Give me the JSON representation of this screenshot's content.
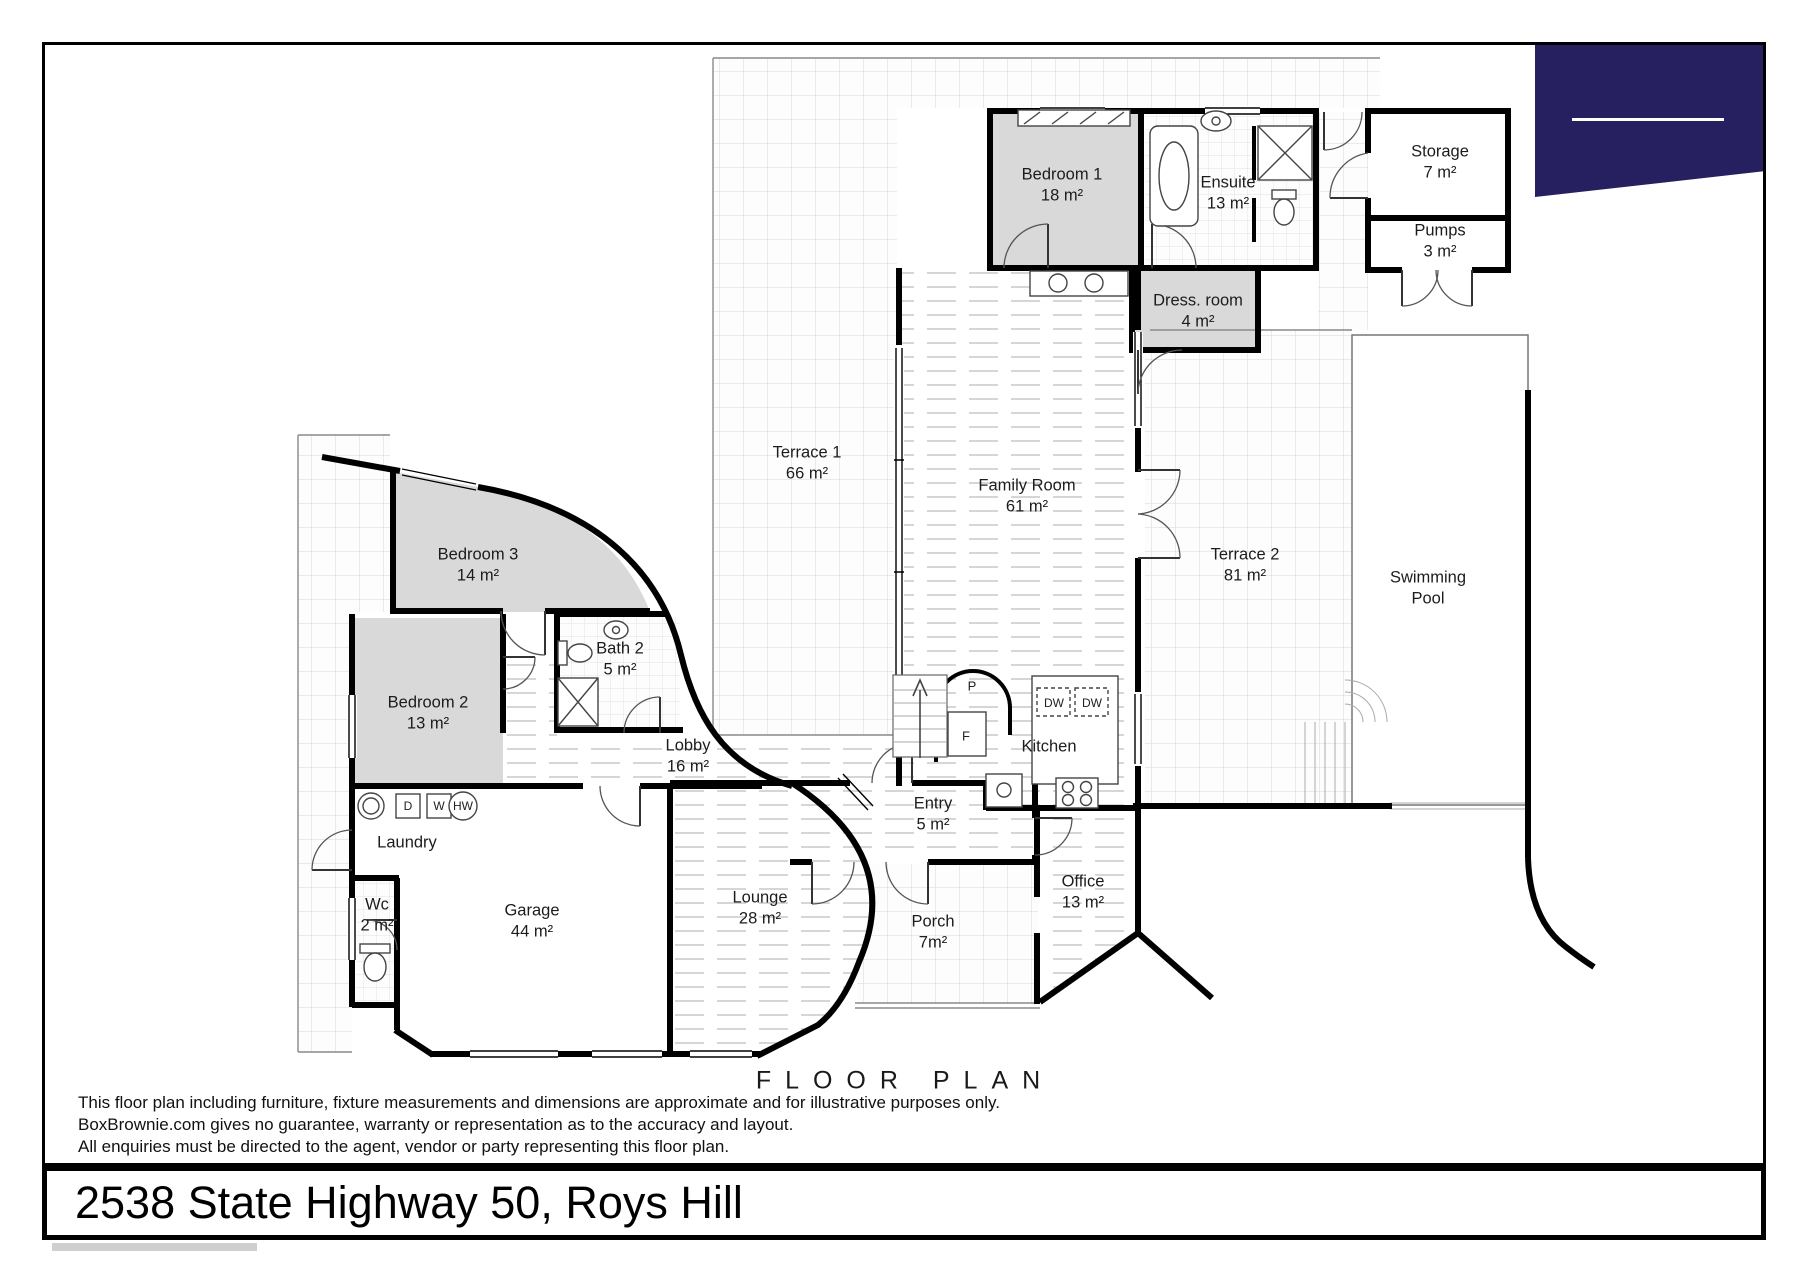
{
  "title": "FLOOR PLAN",
  "address": "2538 State Highway 50, Roys Hill",
  "disclaimer": {
    "line1": "This floor plan including furniture, fixture measurements and dimensions are approximate and for illustrative purposes only.",
    "line2": "BoxBrownie.com gives no guarantee, warranty or representation as to the accuracy and layout.",
    "line3": "All enquiries must be directed to the agent, vendor or party representing this floor plan."
  },
  "rooms": [
    {
      "id": "bedroom-1",
      "line1": "Bedroom 1",
      "line2": "18 m²"
    },
    {
      "id": "ensuite",
      "line1": "Ensuite",
      "line2": "13 m²"
    },
    {
      "id": "storage",
      "line1": "Storage",
      "line2": "7 m²"
    },
    {
      "id": "pumps",
      "line1": "Pumps",
      "line2": "3 m²"
    },
    {
      "id": "dress-room",
      "line1": "Dress. room",
      "line2": "4 m²"
    },
    {
      "id": "terrace-1",
      "line1": "Terrace 1",
      "line2": "66 m²"
    },
    {
      "id": "family-room",
      "line1": "Family Room",
      "line2": "61 m²"
    },
    {
      "id": "terrace-2",
      "line1": "Terrace 2",
      "line2": "81 m²"
    },
    {
      "id": "swimming-pool",
      "line1": "Swimming",
      "line2": "Pool"
    },
    {
      "id": "bedroom-3",
      "line1": "Bedroom 3",
      "line2": "14 m²"
    },
    {
      "id": "bath-2",
      "line1": "Bath 2",
      "line2": "5 m²"
    },
    {
      "id": "bedroom-2",
      "line1": "Bedroom 2",
      "line2": "13 m²"
    },
    {
      "id": "lobby",
      "line1": "Lobby",
      "line2": "16 m²"
    },
    {
      "id": "kitchen",
      "line1": "Kitchen",
      "line2": ""
    },
    {
      "id": "entry",
      "line1": "Entry",
      "line2": "5 m²"
    },
    {
      "id": "laundry",
      "line1": "Laundry",
      "line2": ""
    },
    {
      "id": "wc",
      "line1": "Wc",
      "line2": "2 m²"
    },
    {
      "id": "garage",
      "line1": "Garage",
      "line2": "44 m²"
    },
    {
      "id": "lounge",
      "line1": "Lounge",
      "line2": "28 m²"
    },
    {
      "id": "porch",
      "line1": "Porch",
      "line2": "7m²"
    },
    {
      "id": "office",
      "line1": "Office",
      "line2": "13 m²"
    }
  ],
  "fixtures": {
    "pantry": "P",
    "fridge": "F",
    "dishwasher": "DW",
    "dryer": "D",
    "washer": "W",
    "hot_water": "HW"
  },
  "colors": {
    "banner_navy": "#262061",
    "wall_black": "#000000",
    "room_gray": "#d9d9d9"
  }
}
